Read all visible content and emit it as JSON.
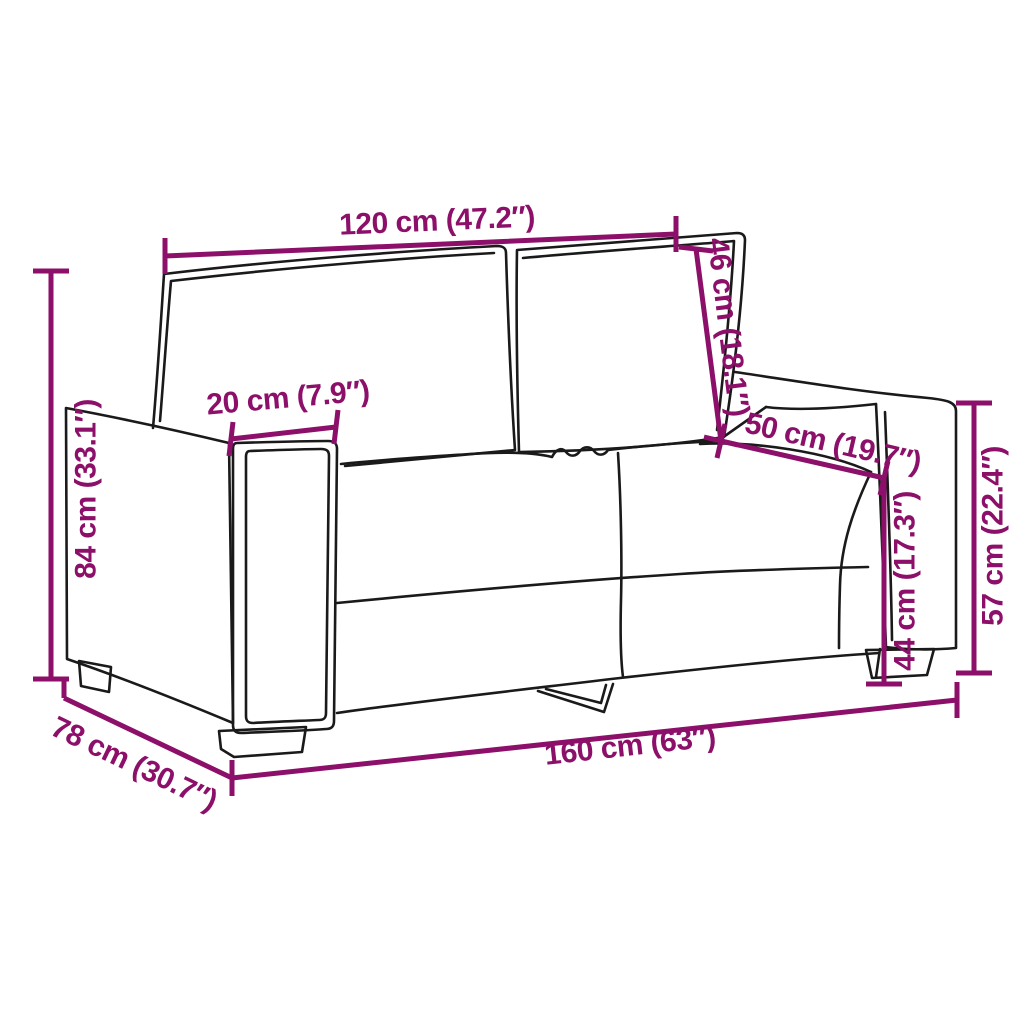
{
  "title": "Two-seater sofa dimension diagram",
  "colors": {
    "dimension_annotation": "#8C0F69",
    "sofa_outline": "#1A1A1A",
    "background": "#FFFFFF"
  },
  "sofa": {
    "description": "Hand-drawn outline of a 2-seater sofa, three-quarter front-left view, two back cushions, two seat cushions, block legs and one V-shaped center leg"
  },
  "dimensions": {
    "back_width": {
      "label": "120 cm (47.2″)",
      "meaning": "width across backrest cushions"
    },
    "backrest_height": {
      "label": "46 cm (18.1″)",
      "meaning": "backrest cushion height"
    },
    "armrest_width": {
      "label": "20 cm (7.9″)",
      "meaning": "armrest width"
    },
    "seat_depth": {
      "label": "50 cm (19.7″)",
      "meaning": "seat depth"
    },
    "overall_height": {
      "label": "84 cm (33.1″)",
      "meaning": "overall height"
    },
    "seat_height": {
      "label": "44 cm (17.3″)",
      "meaning": "seat height from floor"
    },
    "armrest_height": {
      "label": "57 cm (22.4″)",
      "meaning": "armrest height from floor"
    },
    "overall_depth": {
      "label": "78 cm (30.7″)",
      "meaning": "overall depth"
    },
    "overall_width": {
      "label": "160 cm (63″)",
      "meaning": "overall width"
    }
  }
}
